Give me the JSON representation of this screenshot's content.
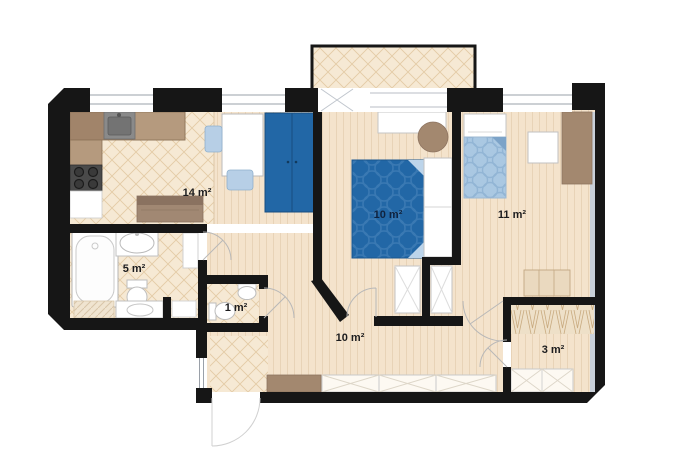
{
  "rooms": [
    {
      "id": "living-kitchen",
      "label": "14 m²"
    },
    {
      "id": "bedroom-main",
      "label": "10 m²"
    },
    {
      "id": "bedroom-second",
      "label": "11 m²"
    },
    {
      "id": "bathroom",
      "label": "5 m²"
    },
    {
      "id": "wc",
      "label": "1 m²"
    },
    {
      "id": "hallway",
      "label": "10 m²"
    },
    {
      "id": "closet",
      "label": "3 m²"
    }
  ],
  "colors": {
    "wall": "#161616",
    "wood_floor": "#f4e3cc",
    "tile_floor": "#f6e9d4",
    "tile_line": "#e3cba6",
    "dark_blue": "#2267a6",
    "light_blue": "#abc9e2",
    "brown": "#a3886f",
    "shadow": "#c9d0d9"
  },
  "furniture_icons": [
    "kitchen-counter",
    "kitchen-sink",
    "stove",
    "sofa",
    "desk",
    "chair",
    "tall-wardrobe",
    "double-bed",
    "single-bed",
    "pouf",
    "nightstand",
    "dresser",
    "bathtub",
    "washbasin",
    "toilet",
    "washing-machine",
    "built-in-wardrobe",
    "clothes-rail",
    "bench",
    "entrance-door",
    "balcony"
  ]
}
